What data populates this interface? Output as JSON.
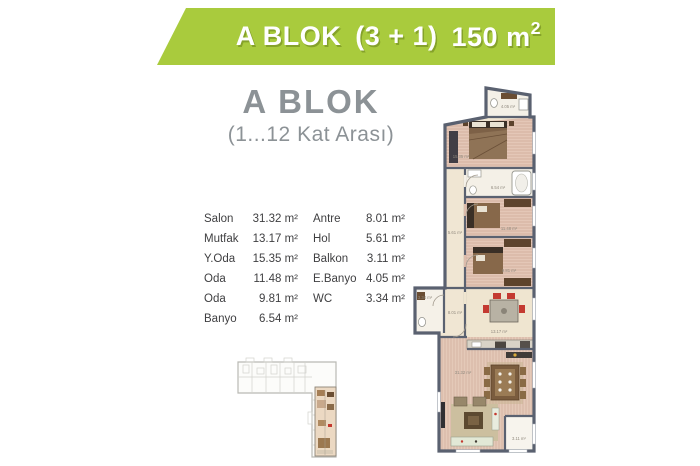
{
  "banner": {
    "block": "A BLOK",
    "type": "(3 + 1)",
    "area": "150 m",
    "area_sup": "2",
    "bg_color": "#a9cb3d",
    "text_color": "#ffffff"
  },
  "heading": {
    "title": "A BLOK",
    "subtitle": "(1...12 Kat Arası)",
    "color": "#8c9296"
  },
  "rooms": {
    "left": [
      {
        "name": "Salon",
        "area": "31.32 m²"
      },
      {
        "name": "Mutfak",
        "area": "13.17 m²"
      },
      {
        "name": "Y.Oda",
        "area": "15.35 m²"
      },
      {
        "name": "Oda",
        "area": "11.48 m²"
      },
      {
        "name": "Oda",
        "area": "9.81 m²"
      },
      {
        "name": "Banyo",
        "area": "6.54 m²"
      }
    ],
    "right": [
      {
        "name": "Antre",
        "area": "8.01 m²"
      },
      {
        "name": "Hol",
        "area": "5.61 m²"
      },
      {
        "name": "Balkon",
        "area": "3.11 m²"
      },
      {
        "name": "E.Banyo",
        "area": "4.05 m²"
      },
      {
        "name": "WC",
        "area": "3.34 m²"
      }
    ]
  },
  "plan": {
    "wall_color": "#5a6170",
    "bedroom_floor": "#dcbcab",
    "hall_floor": "#f0e6d3",
    "bath_floor": "#f4f0e7",
    "labels": [
      {
        "t": "4.05 m²"
      },
      {
        "t": "15.35 m²"
      },
      {
        "t": "6.54 m²"
      },
      {
        "t": "5.61 m²"
      },
      {
        "t": "11.48 m²"
      },
      {
        "t": "9.81 m²"
      },
      {
        "t": "3.34 m²"
      },
      {
        "t": "8.01 m²"
      },
      {
        "t": "13.17 m²"
      },
      {
        "t": "31.32 m²"
      },
      {
        "t": "3.11 m²"
      }
    ]
  }
}
